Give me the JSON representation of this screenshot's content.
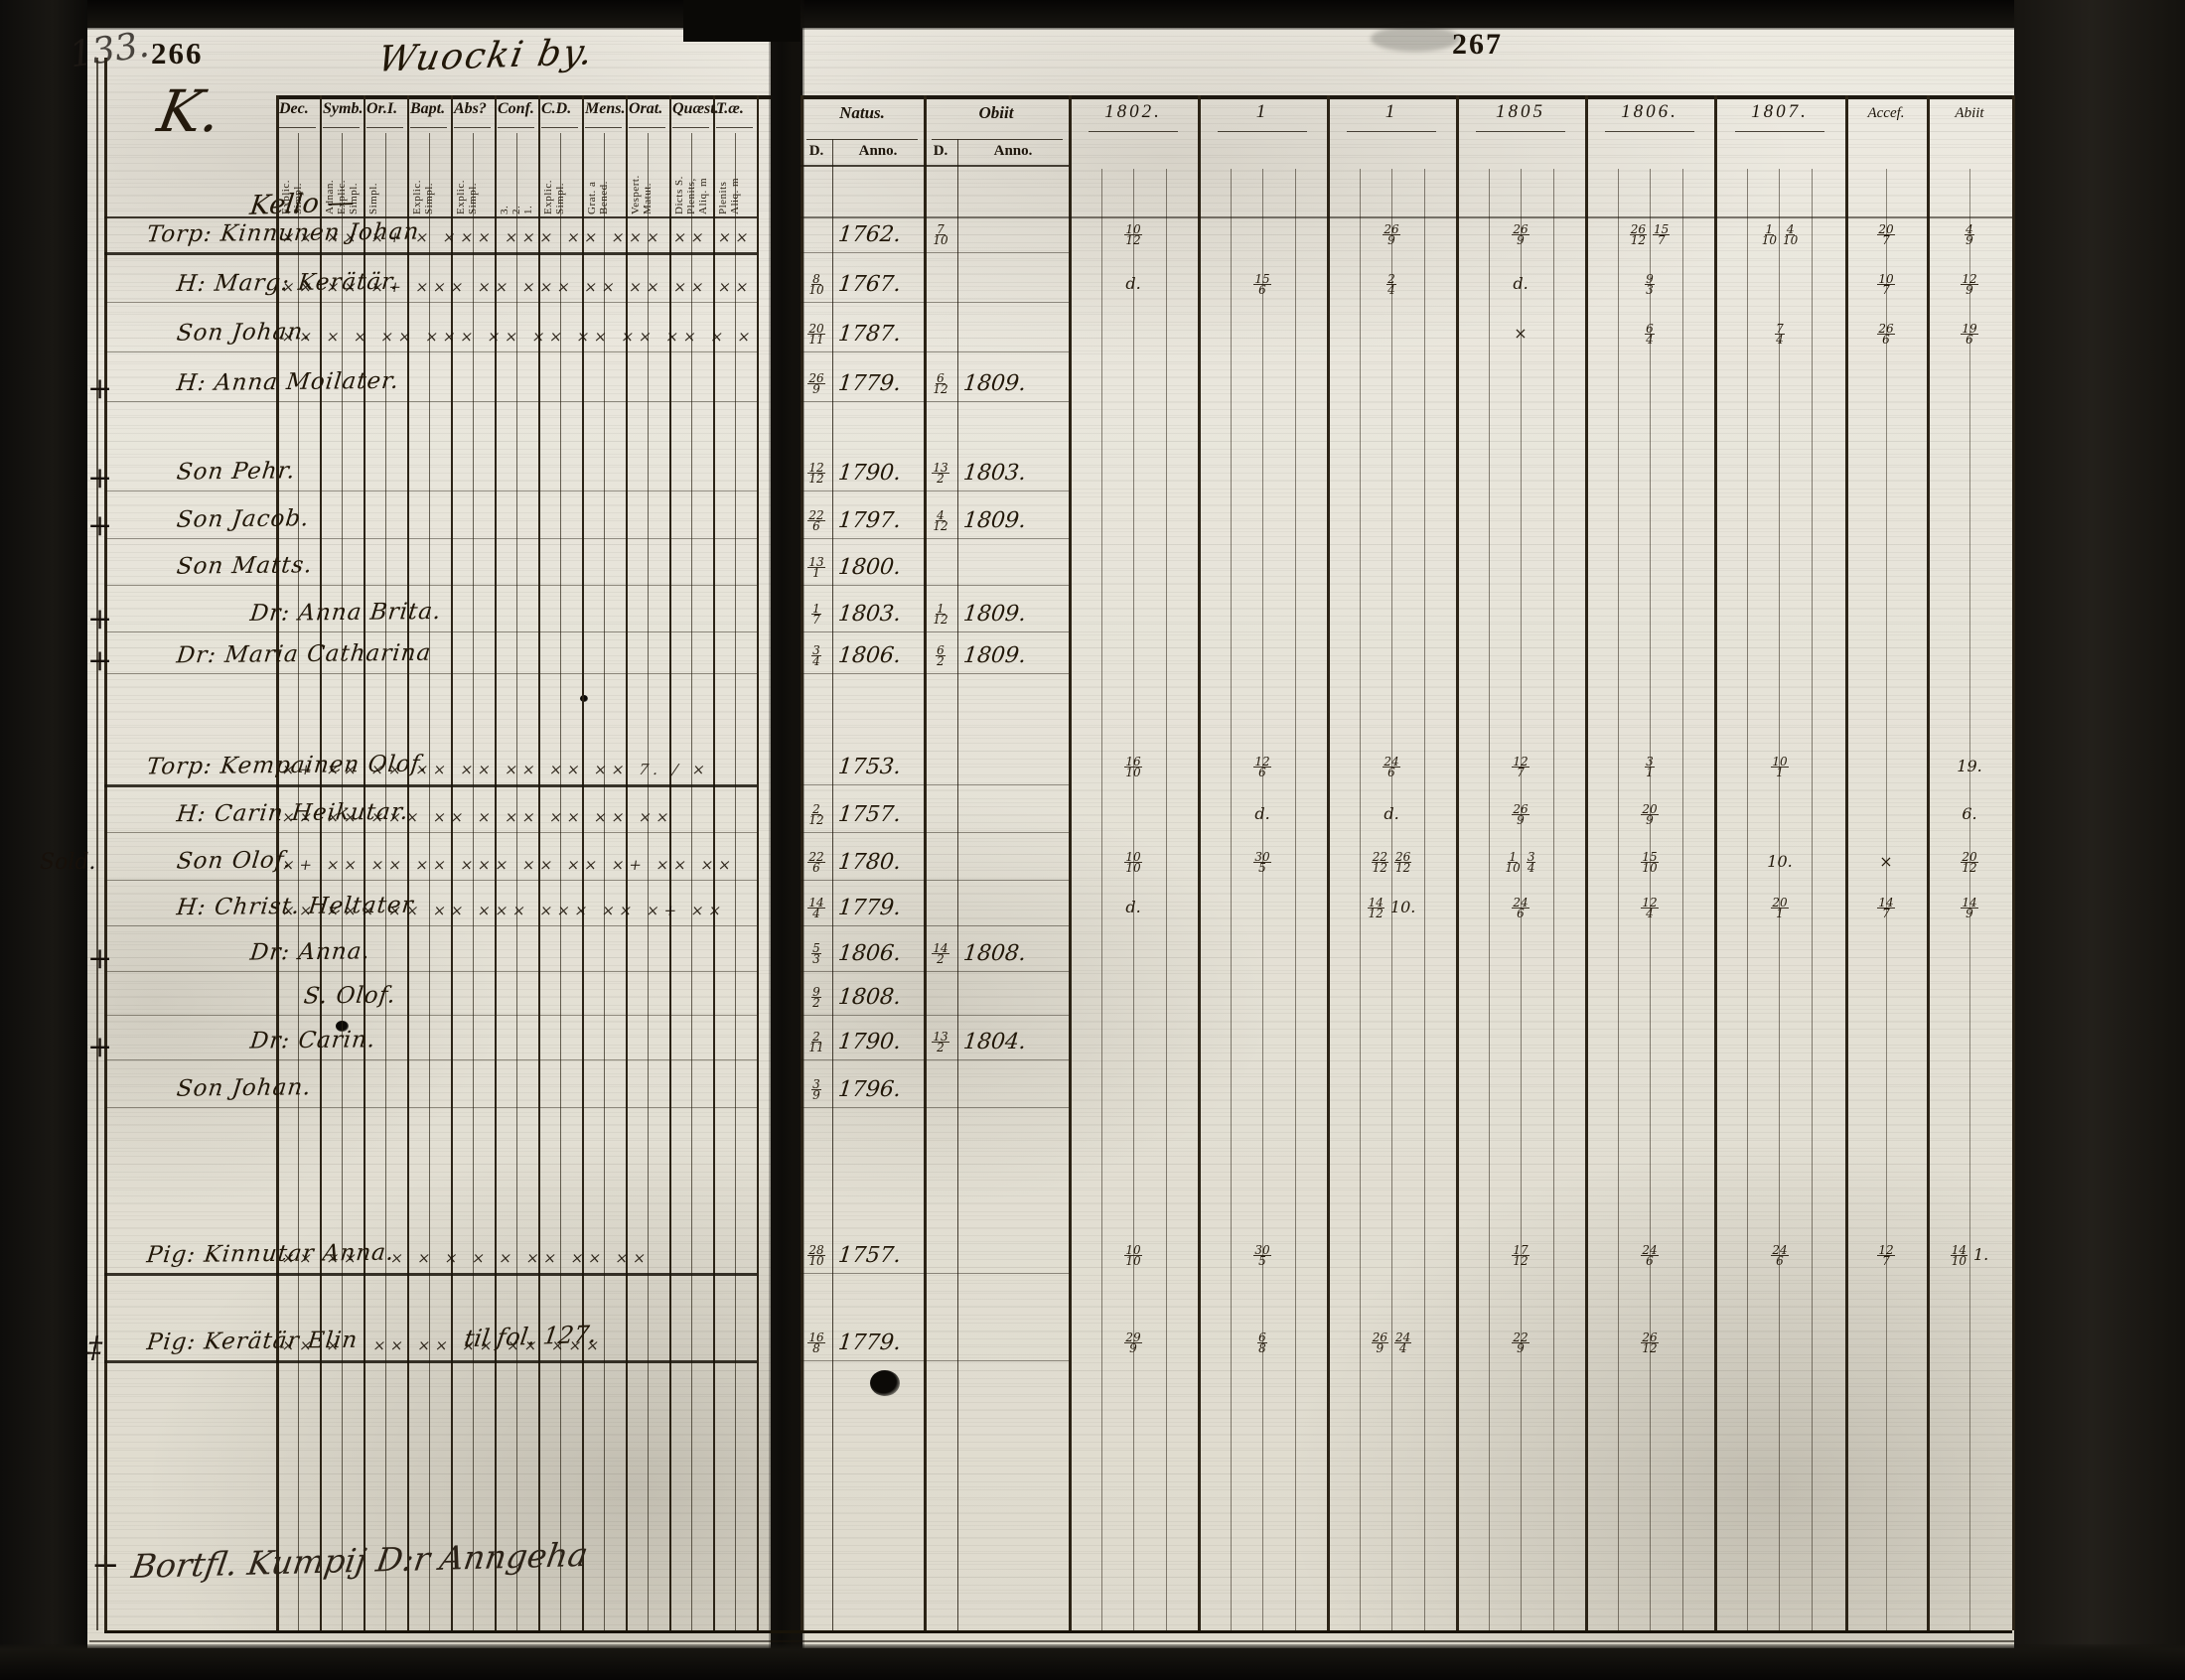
{
  "meta": {
    "left_number": "133.",
    "left_folio": "266",
    "right_folio": "267",
    "title": "Wuocki by."
  },
  "left_table": {
    "section_letter": "K.",
    "farm_name": "Kello —",
    "columns": [
      {
        "label": "Dec.",
        "subs": [
          "Explic.",
          "Simpl."
        ]
      },
      {
        "label": "Symb.",
        "subs": [
          "Adnan.",
          "Explic.",
          "Simpl."
        ]
      },
      {
        "label": "Or.I.",
        "subs": [
          "Simpl."
        ]
      },
      {
        "label": "Bapt.",
        "subs": [
          "Explic.",
          "Simpl."
        ]
      },
      {
        "label": "Abs?",
        "subs": [
          "Explic.",
          "Simpl."
        ]
      },
      {
        "label": "Conf.",
        "subs": [
          "3.",
          "2.",
          "1."
        ]
      },
      {
        "label": "C.D.",
        "subs": [
          "Explic.",
          "Simpl."
        ]
      },
      {
        "label": "Mens.",
        "subs": [
          "Grat. a",
          "Bened."
        ]
      },
      {
        "label": "Orat.",
        "subs": [
          "Vespert.",
          "Matut."
        ]
      },
      {
        "label": "Quæst.",
        "subs": [
          "Dicts S.",
          "Plenits,",
          "Aliq. m"
        ]
      },
      {
        "label": "T.æ.",
        "subs": [
          "Plenits",
          "Aliq. m"
        ]
      }
    ]
  },
  "right_table": {
    "natus_label": "Natus.",
    "natus_subs": [
      "D.",
      "Anno."
    ],
    "obiit_label": "Obiit",
    "obiit_subs": [
      "D.",
      "Anno."
    ],
    "year_columns": [
      "1802.",
      "1",
      "1",
      "1805",
      "1806.",
      "1807."
    ],
    "accessit_label": "Accef.",
    "abiit_label": "Abiit"
  },
  "rows": [
    {
      "margin": "",
      "name": "Torp: Kinnunen Johan",
      "marks": "×× ×× ×+ × ××× ××× ×× ××× ×× ×× × × ××",
      "natus_d": "",
      "natus_y": "1762.",
      "obiit_d": "7/10",
      "obiit_y": "",
      "years": [
        "10/12",
        "",
        "26/9",
        "26/9",
        "26/12 15/7",
        "1/10 4/10"
      ],
      "accessit": "20/7",
      "abiit": "4/9"
    },
    {
      "margin": "",
      "name": "H: Marg: Kerätär.",
      "marks": "×× ×× ×+ ××× ×× ××× ×× ×× ×× ×× ×× ××",
      "natus_d": "8/10",
      "natus_y": "1767.",
      "obiit_d": "",
      "obiit_y": "",
      "years": [
        "d.",
        "15/6",
        "2/4",
        "d.",
        "9/3",
        ""
      ],
      "accessit": "10/7",
      "abiit": "12/9"
    },
    {
      "margin": "",
      "name": "Son Johan.",
      "marks": "×× × × ×× ××× ×× ×× ×× ×× ×× × ××",
      "natus_d": "20/11",
      "natus_y": "1787.",
      "obiit_d": "",
      "obiit_y": "",
      "years": [
        "",
        "",
        "",
        "×",
        "6/4",
        "7/4"
      ],
      "accessit": "26/6",
      "abiit": "19/6"
    },
    {
      "margin": "+",
      "name": "H: Anna Moilater.",
      "marks": "",
      "natus_d": "26/9",
      "natus_y": "1779.",
      "obiit_d": "6/12",
      "obiit_y": "1809.",
      "years": [
        "",
        "",
        "",
        "",
        "",
        ""
      ],
      "accessit": "",
      "abiit": ""
    },
    {
      "margin": "+",
      "name": "Son Pehr.",
      "marks": "",
      "natus_d": "12/12",
      "natus_y": "1790.",
      "obiit_d": "13/2",
      "obiit_y": "1803.",
      "years": [
        "",
        "",
        "",
        "",
        "",
        ""
      ],
      "accessit": "",
      "abiit": ""
    },
    {
      "margin": "+",
      "name": "Son Jacob.",
      "marks": "",
      "natus_d": "22/6",
      "natus_y": "1797.",
      "obiit_d": "4/12",
      "obiit_y": "1809.",
      "years": [
        "",
        "",
        "",
        "",
        "",
        ""
      ],
      "accessit": "",
      "abiit": ""
    },
    {
      "margin": "",
      "name": "Son Matts.",
      "marks": "",
      "natus_d": "13/1",
      "natus_y": "1800.",
      "obiit_d": "",
      "obiit_y": "",
      "years": [
        "",
        "",
        "",
        "",
        "",
        ""
      ],
      "accessit": "",
      "abiit": ""
    },
    {
      "margin": "+",
      "name": "Dr: Anna Brita.",
      "marks": "",
      "natus_d": "1/7",
      "natus_y": "1803.",
      "obiit_d": "1/12",
      "obiit_y": "1809.",
      "years": [
        "",
        "",
        "",
        "",
        "",
        ""
      ],
      "accessit": "",
      "abiit": ""
    },
    {
      "margin": "+",
      "name": "Dr: Maria Catharina",
      "marks": "",
      "natus_d": "3/4",
      "natus_y": "1806.",
      "obiit_d": "6/2",
      "obiit_y": "1809.",
      "years": [
        "",
        "",
        "",
        "",
        "",
        ""
      ],
      "accessit": "",
      "abiit": ""
    },
    {
      "margin": "",
      "name": "Torp: Kempainen Olof.",
      "marks": "×+ ×× ×× ×× ×× ×× ×× ×× 7. / ×",
      "natus_d": "",
      "natus_y": "1753.",
      "obiit_d": "",
      "obiit_y": "",
      "years": [
        "16/10",
        "12/6",
        "24/6",
        "12/7",
        "3/1",
        "10/1"
      ],
      "accessit": "",
      "abiit": "19."
    },
    {
      "margin": "",
      "name": "H: Carin Heikutar.",
      "marks": "×× ×× ××× ×× × ×× ×× ×× ××",
      "natus_d": "2/12",
      "natus_y": "1757.",
      "obiit_d": "",
      "obiit_y": "",
      "years": [
        "",
        "d.",
        "d.",
        "26/9",
        "20/9",
        ""
      ],
      "accessit": "",
      "abiit": "6."
    },
    {
      "margin": "Sold.",
      "name": "Son Olof.",
      "marks": "×+ ×× ×× ×× ××× ×× ×× ×+ ×× ××",
      "natus_d": "22/6",
      "natus_y": "1780.",
      "obiit_d": "",
      "obiit_y": "",
      "years": [
        "10/10",
        "30/5",
        "22/12 26/12",
        "1/10 3/4",
        "15/10",
        "10."
      ],
      "accessit": "×",
      "abiit": "20/12"
    },
    {
      "margin": "",
      "name": "H: Christ. Heltater",
      "marks": "×× ××× ×× ×× ××× ××× ×× ×+ ××",
      "natus_d": "14/4",
      "natus_y": "1779.",
      "obiit_d": "",
      "obiit_y": "",
      "years": [
        "d.",
        "",
        "14/12 10.",
        "24/6",
        "12/4",
        "20/1"
      ],
      "accessit": "14/7",
      "abiit": "14/9"
    },
    {
      "margin": "+",
      "name": "Dr: Anna.",
      "marks": "",
      "natus_d": "5/3",
      "natus_y": "1806.",
      "obiit_d": "14/2",
      "obiit_y": "1808.",
      "years": [
        "",
        "",
        "",
        "",
        "",
        ""
      ],
      "accessit": "",
      "abiit": ""
    },
    {
      "margin": "",
      "name": "S. Olof.",
      "marks": "",
      "natus_d": "9/2",
      "natus_y": "1808.",
      "obiit_d": "",
      "obiit_y": "",
      "years": [
        "",
        "",
        "",
        "",
        "",
        ""
      ],
      "accessit": "",
      "abiit": ""
    },
    {
      "margin": "+",
      "name": "Dr: Carin.",
      "marks": "",
      "natus_d": "2/11",
      "natus_y": "1790.",
      "obiit_d": "13/2",
      "obiit_y": "1804.",
      "years": [
        "",
        "",
        "",
        "",
        "",
        ""
      ],
      "accessit": "",
      "abiit": ""
    },
    {
      "margin": "",
      "name": "Son Johan.",
      "marks": "",
      "natus_d": "3/9",
      "natus_y": "1796.",
      "obiit_d": "",
      "obiit_y": "",
      "years": [
        "",
        "",
        "",
        "",
        "",
        ""
      ],
      "accessit": "",
      "abiit": ""
    },
    {
      "margin": "",
      "name": "Pig: Kinnutar Anna.",
      "marks": "×× ××   × × × × × ×× ×× ××",
      "natus_d": "28/10",
      "natus_y": "1757.",
      "obiit_d": "",
      "obiit_y": "",
      "years": [
        "10/10",
        "30/5",
        "",
        "17/12",
        "24/6",
        "24/6"
      ],
      "accessit": "12/7",
      "abiit": "14/10 1."
    },
    {
      "margin": "‡",
      "name": "Pig: Kerätär Elin",
      "marks": "×× ×   ×× ×× ×× ×× ×××",
      "note": "til fol. 127.",
      "natus_d": "16/8",
      "natus_y": "1779.",
      "obiit_d": "",
      "obiit_y": "",
      "years": [
        "29/9",
        "6/8",
        "26/9 24/4",
        "22/9",
        "26/12",
        ""
      ],
      "accessit": "",
      "abiit": ""
    }
  ],
  "notes": {
    "bottom_margin": "+",
    "bottom_text": "Bortfl. Kumpij D:r Anngeha"
  }
}
